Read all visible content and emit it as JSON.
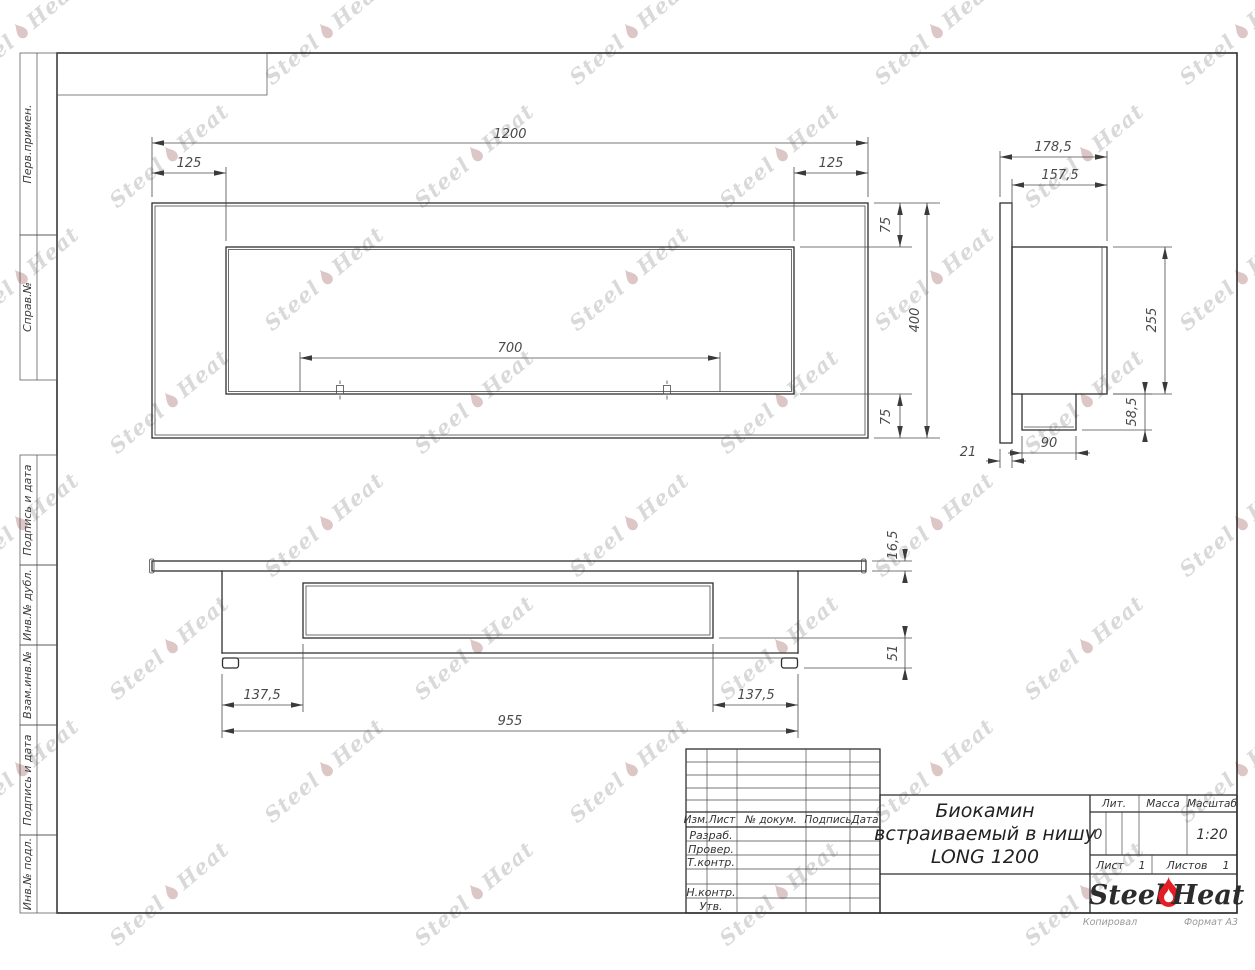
{
  "sheet": {
    "stamp_labels": [
      "Перв.примен.",
      "Справ.№",
      "Подпись и дата",
      "Инв.№ дубл.",
      "Взам.инв.№",
      "Подпись и дата",
      "Инв.№ подл."
    ],
    "copied": "Копировал",
    "format": "Формат А3"
  },
  "watermark": {
    "left": "Steel",
    "right": "Heat"
  },
  "views": {
    "front": {
      "width": "1200",
      "offset_left": "125",
      "offset_right": "125",
      "burner": "700",
      "height": "400",
      "top": "75",
      "bottom": "75"
    },
    "side": {
      "depth": "178,5",
      "body_depth": "157,5",
      "body_height": "255",
      "tray_drop": "58,5",
      "tray_width": "90",
      "flange": "21"
    },
    "bottom": {
      "flange_thickness": "16,5",
      "base_height": "51",
      "offset_left": "137,5",
      "offset_right": "137,5",
      "body_width": "955"
    }
  },
  "title_block": {
    "header": [
      "Изм.",
      "Лист",
      "№ докум.",
      "Подпись",
      "Дата"
    ],
    "rows": [
      "Разраб.",
      "Провер.",
      "Т.контр.",
      "Н.контр.",
      "Утв."
    ],
    "title_lines": [
      "Биокамин",
      "встраиваемый в нишу",
      "LONG 1200"
    ],
    "lit_label": "Лит.",
    "lit_value": "0",
    "mass_label": "Масса",
    "scale_label": "Масштаб",
    "scale_value": "1:20",
    "sheet_label": "Лист",
    "sheet_value": "1",
    "sheets_label": "Листов",
    "sheets_value": "1",
    "logo": {
      "steel": "Steel",
      "heat": "Heat"
    }
  },
  "colors": {
    "line": "#2f2f2f",
    "flame_red": "#e31e24",
    "watermark": "#d9d9d9"
  }
}
